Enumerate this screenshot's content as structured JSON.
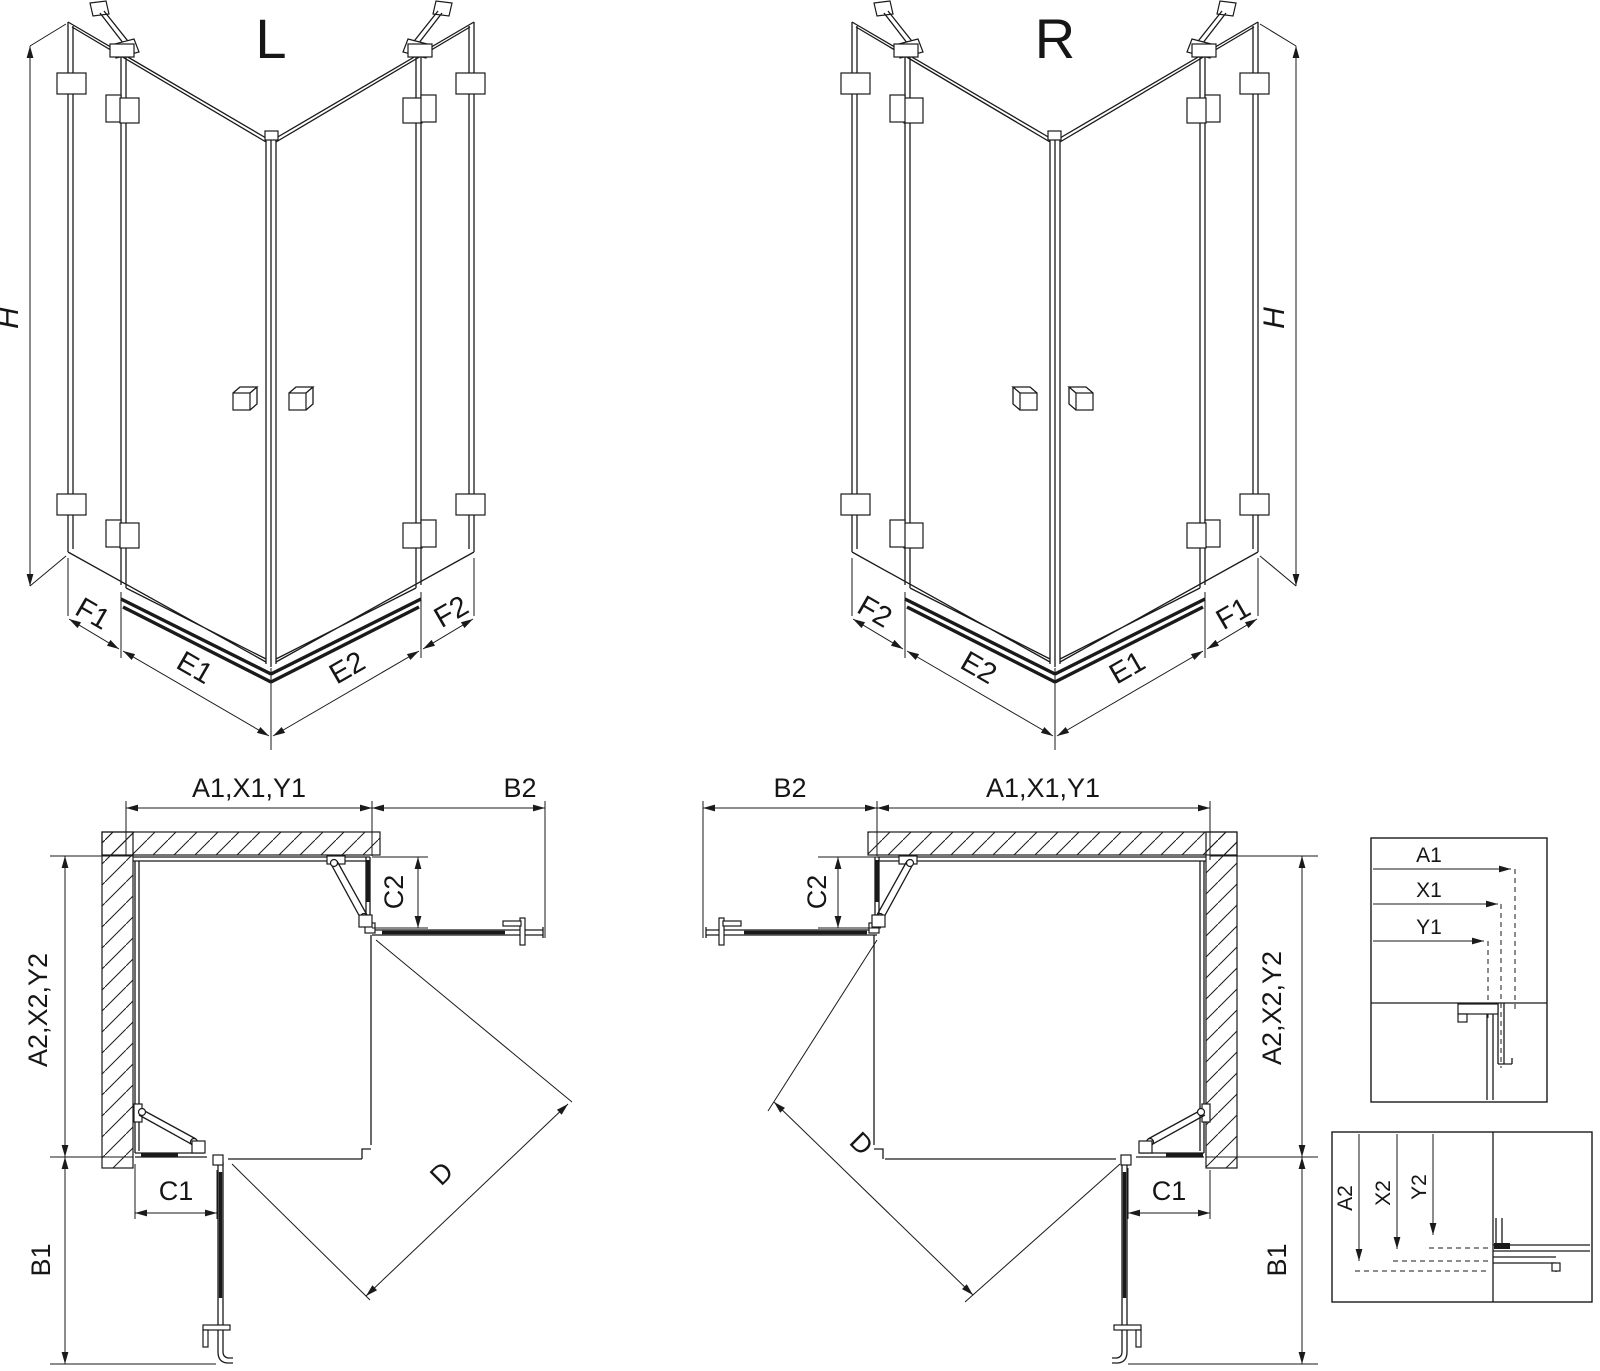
{
  "colors": {
    "ink": "#1a1a1a",
    "background": "#ffffff"
  },
  "views": {
    "perspective_left": {
      "label": "L",
      "h": "H",
      "f1": "F1",
      "e1": "E1",
      "e2": "E2",
      "f2": "F2"
    },
    "perspective_right": {
      "label": "R",
      "h": "H",
      "f1": "F1",
      "e1": "E1",
      "e2": "E2",
      "f2": "F2"
    },
    "plan_left": {
      "a1": "A1,X1,Y1",
      "b2": "B2",
      "c2": "C2",
      "a2": "A2,X2,Y2",
      "b1": "B1",
      "c1": "C1",
      "d": "D"
    },
    "plan_right": {
      "a1": "A1,X1,Y1",
      "b2": "B2",
      "c2": "C2",
      "a2": "A2,X2,Y2",
      "b1": "B1",
      "c1": "C1",
      "d": "D"
    },
    "detail_top": {
      "a1": "A1",
      "x1": "X1",
      "y1": "Y1"
    },
    "detail_bottom": {
      "a2": "A2",
      "x2": "X2",
      "y2": "Y2"
    }
  }
}
